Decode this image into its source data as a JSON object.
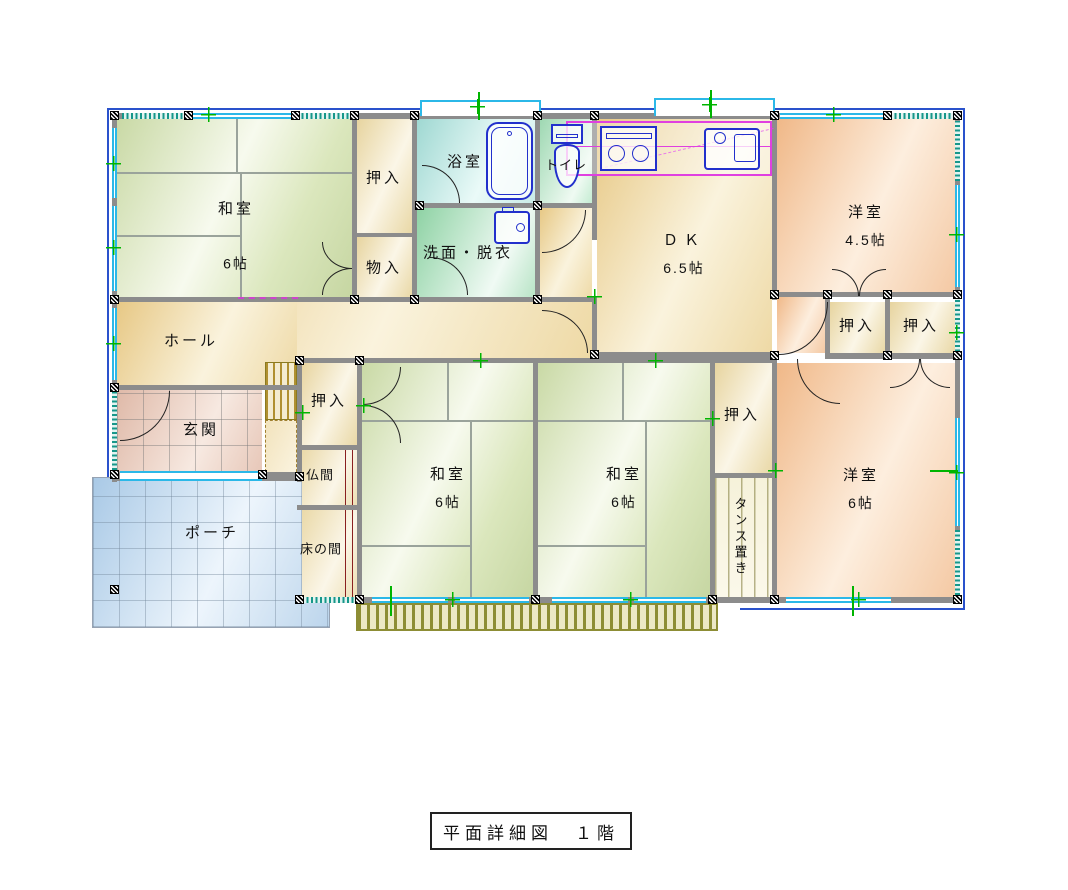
{
  "title": {
    "text": "平面詳細図　１階"
  },
  "rooms": {
    "washitsu_nw": {
      "label": "和室",
      "size": "6帖"
    },
    "oshiire_nw": {
      "label": "押入"
    },
    "monoire": {
      "label": "物入"
    },
    "yokushitsu": {
      "label": "浴室"
    },
    "toire": {
      "label": "トイレ"
    },
    "senmen": {
      "label": "洗面・脱衣"
    },
    "dk": {
      "label": "ＤＫ",
      "size": "6.5帖"
    },
    "yoshitsu_ne": {
      "label": "洋室",
      "size": "4.5帖"
    },
    "oshiire_ne1": {
      "label": "押入"
    },
    "oshiire_ne2": {
      "label": "押入"
    },
    "hall": {
      "label": "ホール"
    },
    "genkan": {
      "label": "玄関"
    },
    "porch": {
      "label": "ポーチ"
    },
    "oshiire_c": {
      "label": "押入"
    },
    "butsuma": {
      "label": "仏間"
    },
    "tokonoma": {
      "label": "床の間"
    },
    "washitsu_c1": {
      "label": "和室",
      "size": "6帖"
    },
    "washitsu_c2": {
      "label": "和室",
      "size": "6帖"
    },
    "oshiire_e": {
      "label": "押入"
    },
    "tansu": {
      "label": "タンス置き"
    },
    "yoshitsu_se": {
      "label": "洋室",
      "size": "6帖"
    }
  },
  "fixtures": [
    "bathtub",
    "toilet",
    "wash-basin",
    "kitchen-stove",
    "kitchen-sink"
  ],
  "colors": {
    "tatami": "#dbe7bd",
    "closet": "#efe0b4",
    "bath": "#c9ece8",
    "toilet": "#c4ecd2",
    "washroom": "#b8e4c6",
    "dk_hall": "#eed9a5",
    "western_room": "#f4c9a4",
    "entrance_tile": "#e7c7b8",
    "porch_tile": "#bcd5ec",
    "deck": "#8d8d35",
    "wall": "#8c8c8c",
    "exterior_line": "#2a52cc",
    "window": "#2bb8e8",
    "kitchen_outline": "#e040e0",
    "fixture_line": "#2230cc",
    "survey_mark": "#00b400"
  }
}
